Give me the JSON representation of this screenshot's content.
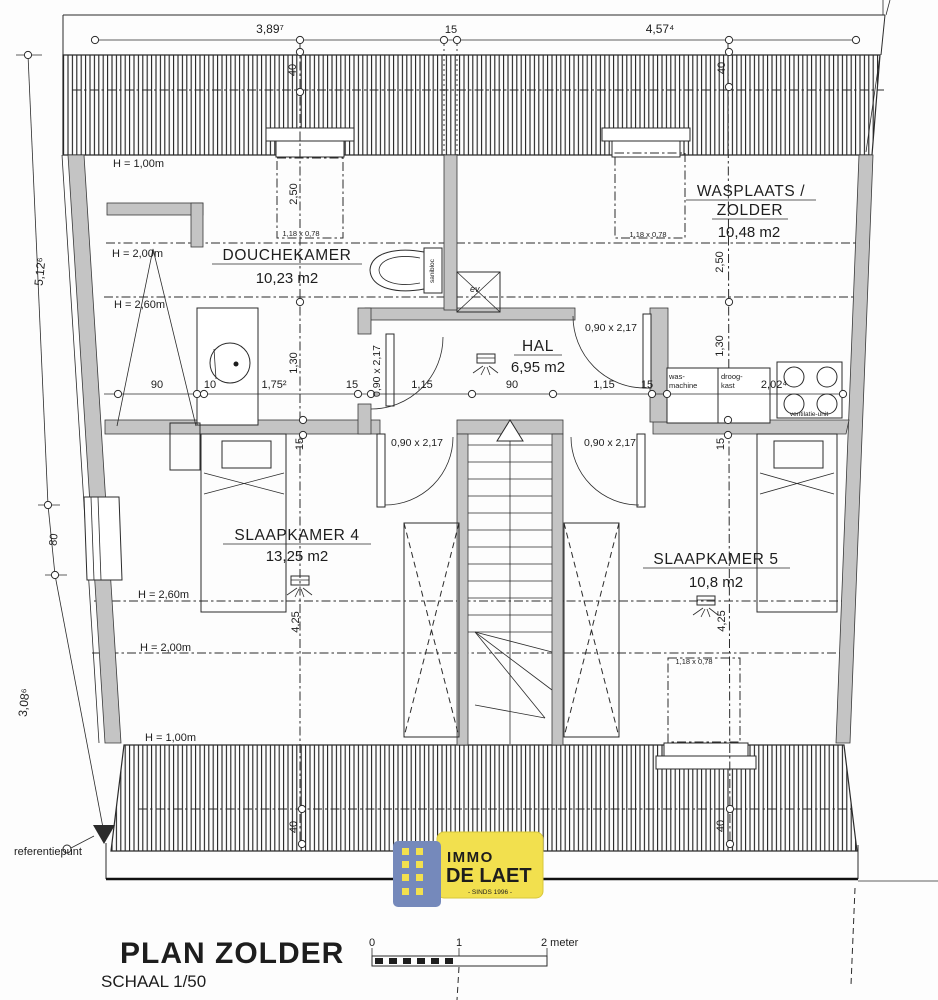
{
  "rooms": {
    "douchekamer": {
      "name": "DOUCHEKAMER",
      "area": "10,23 m2"
    },
    "wasplaats": {
      "name_line1": "WASPLAATS /",
      "name_line2": "ZOLDER",
      "area": "10,48 m2"
    },
    "hal": {
      "name": "HAL",
      "area": "6,95 m2"
    },
    "slaapkamer4": {
      "name": "SLAAPKAMER 4",
      "area": "13,25 m2"
    },
    "slaapkamer5": {
      "name": "SLAAPKAMER 5",
      "area": "10,8 m2"
    }
  },
  "heights": {
    "h100": "H = 1,00m",
    "h200": "H = 2,00m",
    "h260": "H = 2,60m"
  },
  "d": {
    "t1": "3,89⁷",
    "t2": "15",
    "t3": "4,57⁴",
    "v40": "40",
    "l1": "5,12⁶",
    "l2": "80",
    "l3": "3,08⁶",
    "c250": "2,50",
    "c130": "1,30",
    "c15": "15",
    "c425": "4,25",
    "r90": "90",
    "r10": "10",
    "r175": "1,75²",
    "r15": "15",
    "r115": "1,15",
    "r202": "2,02⁴",
    "door": "0,90 x 2,17",
    "win": "1,18 x 0,78"
  },
  "fixtures": {
    "wasmachine_l1": "was-",
    "wasmachine_l2": "machine",
    "droogkast_l1": "droog-",
    "droogkast_l2": "kast",
    "ventilatie": "ventilatie-unit",
    "sanibloc": "sanibloc",
    "ev": "ev"
  },
  "reference": "referentiepunt",
  "titleblock": {
    "title": "PLAN ZOLDER",
    "scale": "SCHAAL 1/50"
  },
  "scalebar": {
    "zero": "0",
    "one": "1",
    "two": "2 meter"
  },
  "logo": {
    "immo": "IMMO",
    "delaet": "DE LAET",
    "sinds": "- SINDS 1996 -"
  },
  "colors": {
    "wall": "#c4c4c4",
    "logo_yellow": "#f2e04e",
    "logo_blue": "#7589bb",
    "logo_text_blue": "#5671ae",
    "logo_text_light": "#8494b6"
  }
}
